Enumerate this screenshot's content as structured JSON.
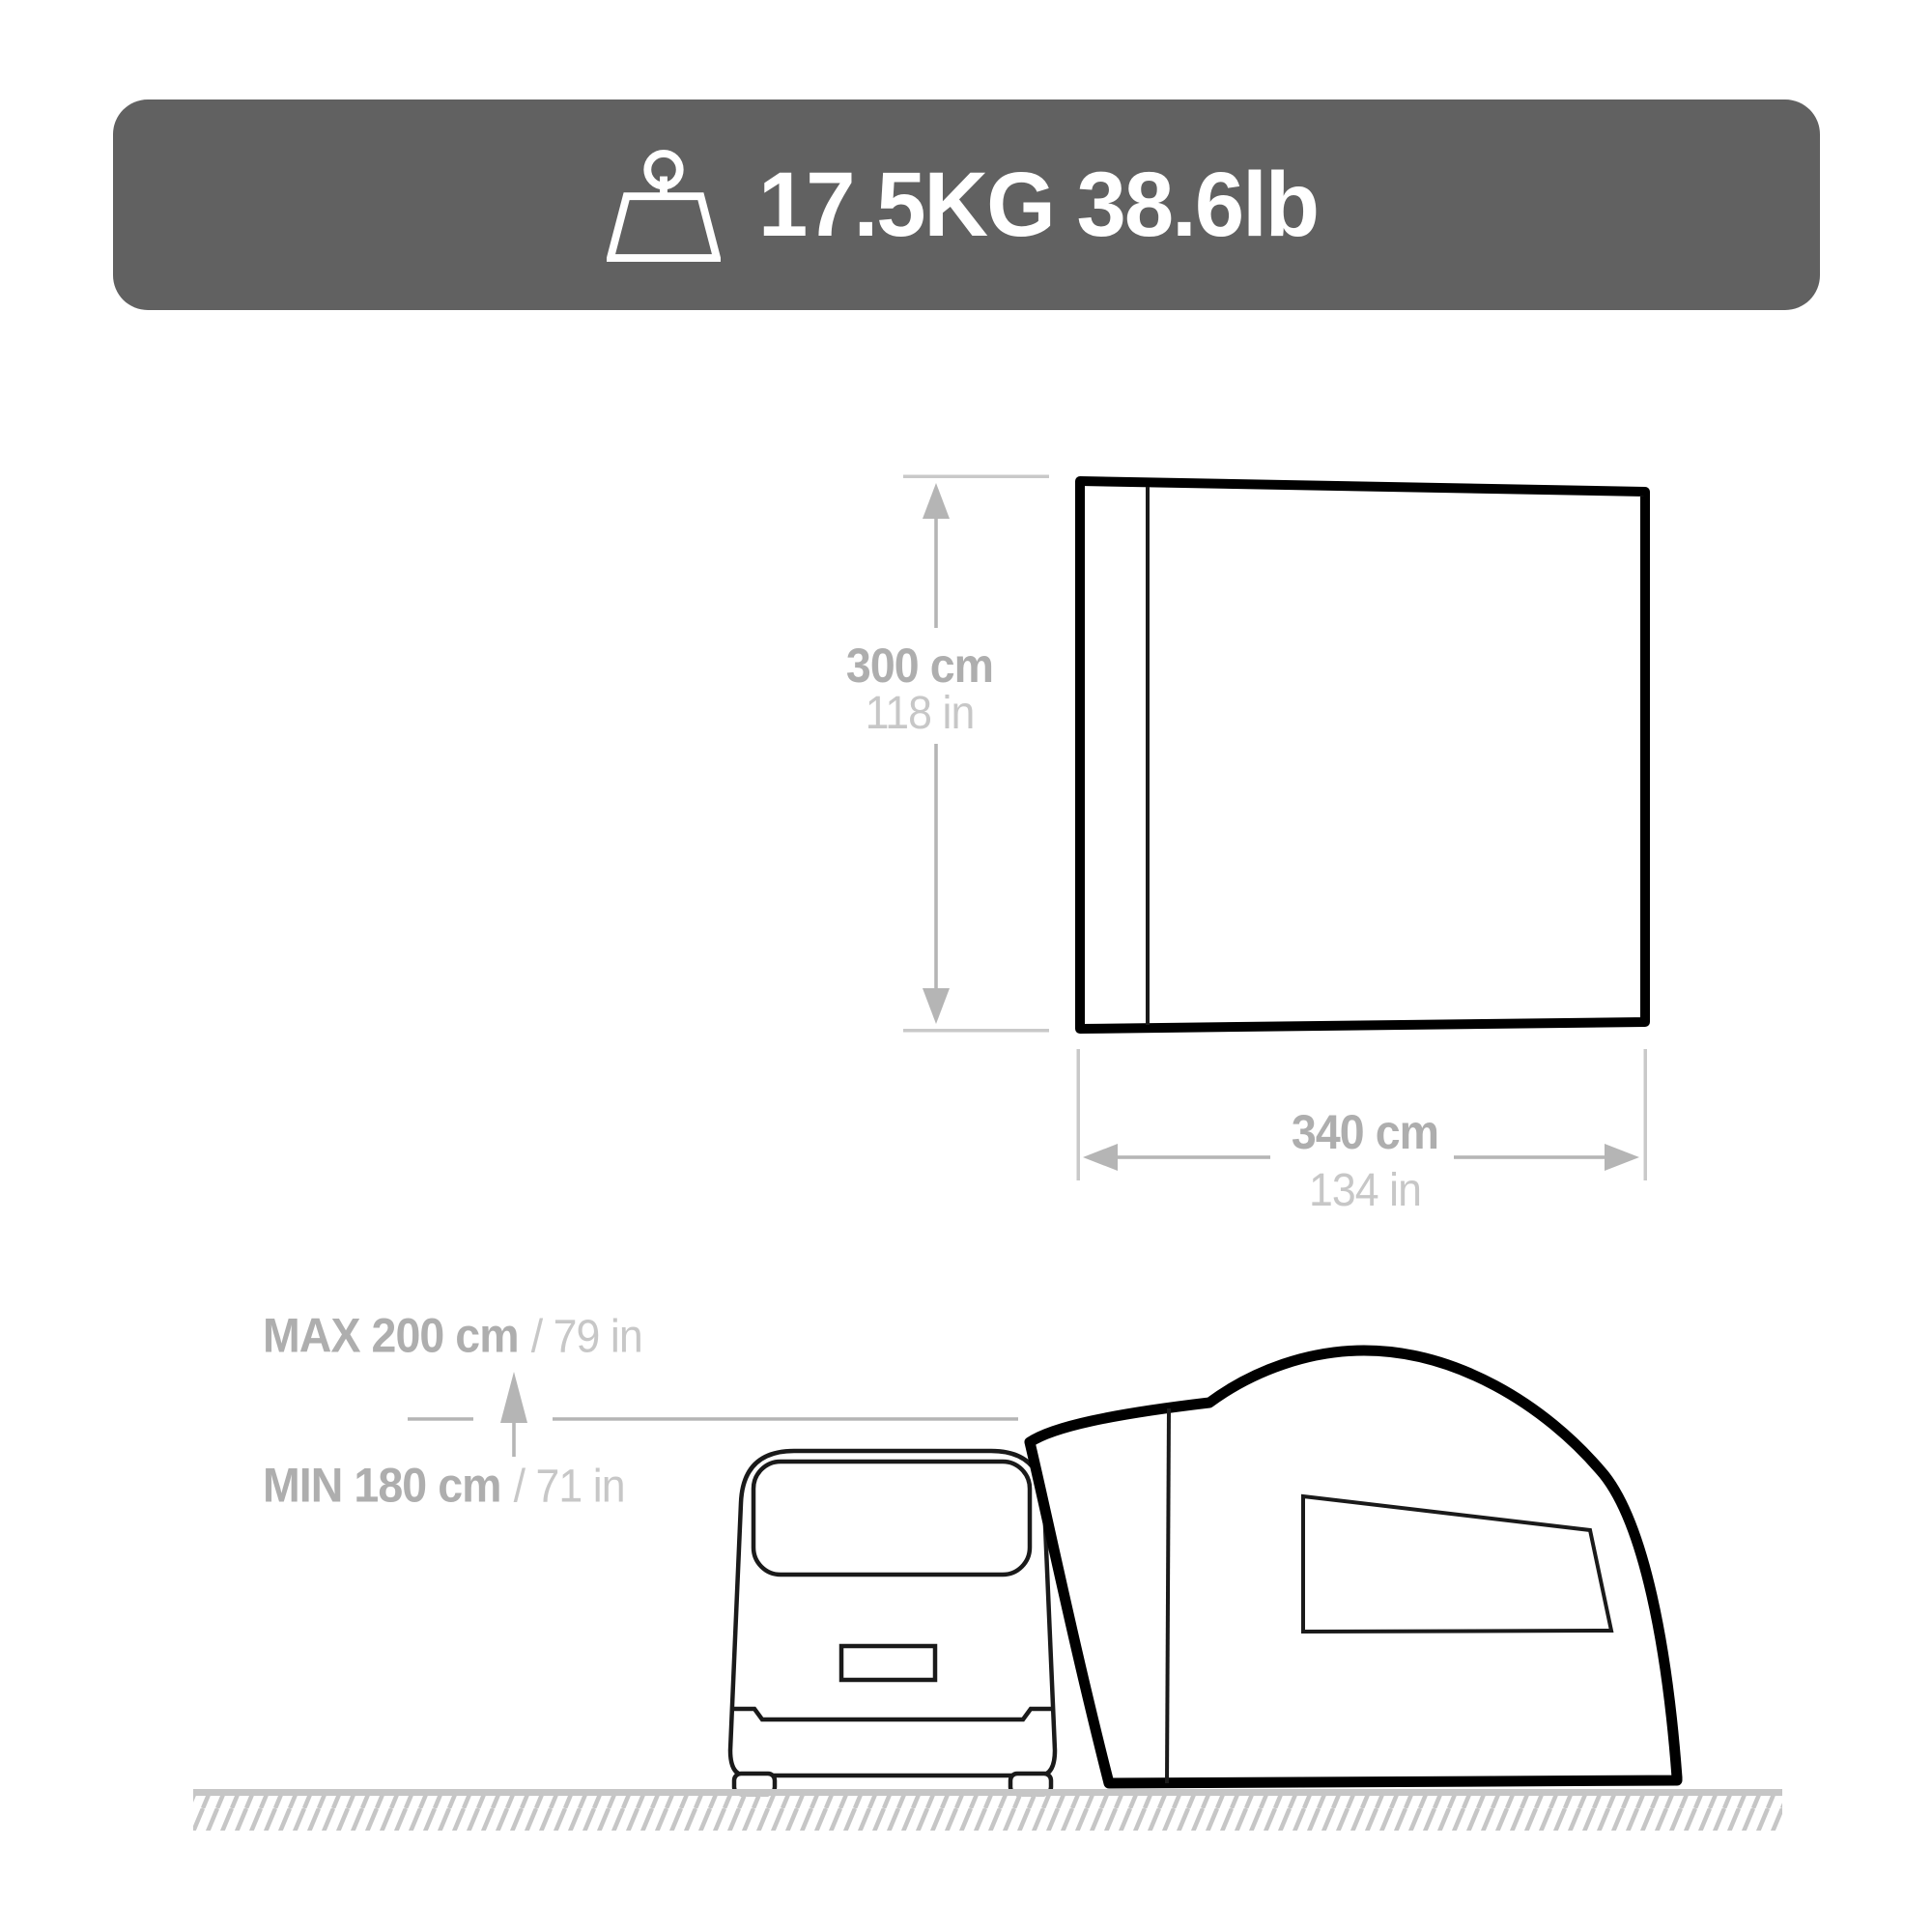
{
  "banner": {
    "label": "17.5KG 38.6lb",
    "icon": "weight-icon",
    "background": "#616161",
    "text_color": "#ffffff"
  },
  "top_view": {
    "height": {
      "primary": "300 cm",
      "secondary": "118 in"
    },
    "width": {
      "primary": "340 cm",
      "secondary": "134 in"
    }
  },
  "side_view": {
    "max_height": {
      "primary": "MAX 200 cm",
      "secondary": "/ 79 in"
    },
    "min_height": {
      "primary": "MIN 180 cm",
      "secondary": "/ 71 in"
    }
  },
  "colors": {
    "banner_bg": "#616161",
    "tent_outline": "#000000",
    "van_stroke": "#1a1a1a",
    "dim_bold_text": "#aeaeae",
    "dim_light_text": "#c7c7c7",
    "dim_line": "#b5b5b5",
    "extension_line": "#c9c9c9",
    "ground": "#c6c6c6"
  }
}
